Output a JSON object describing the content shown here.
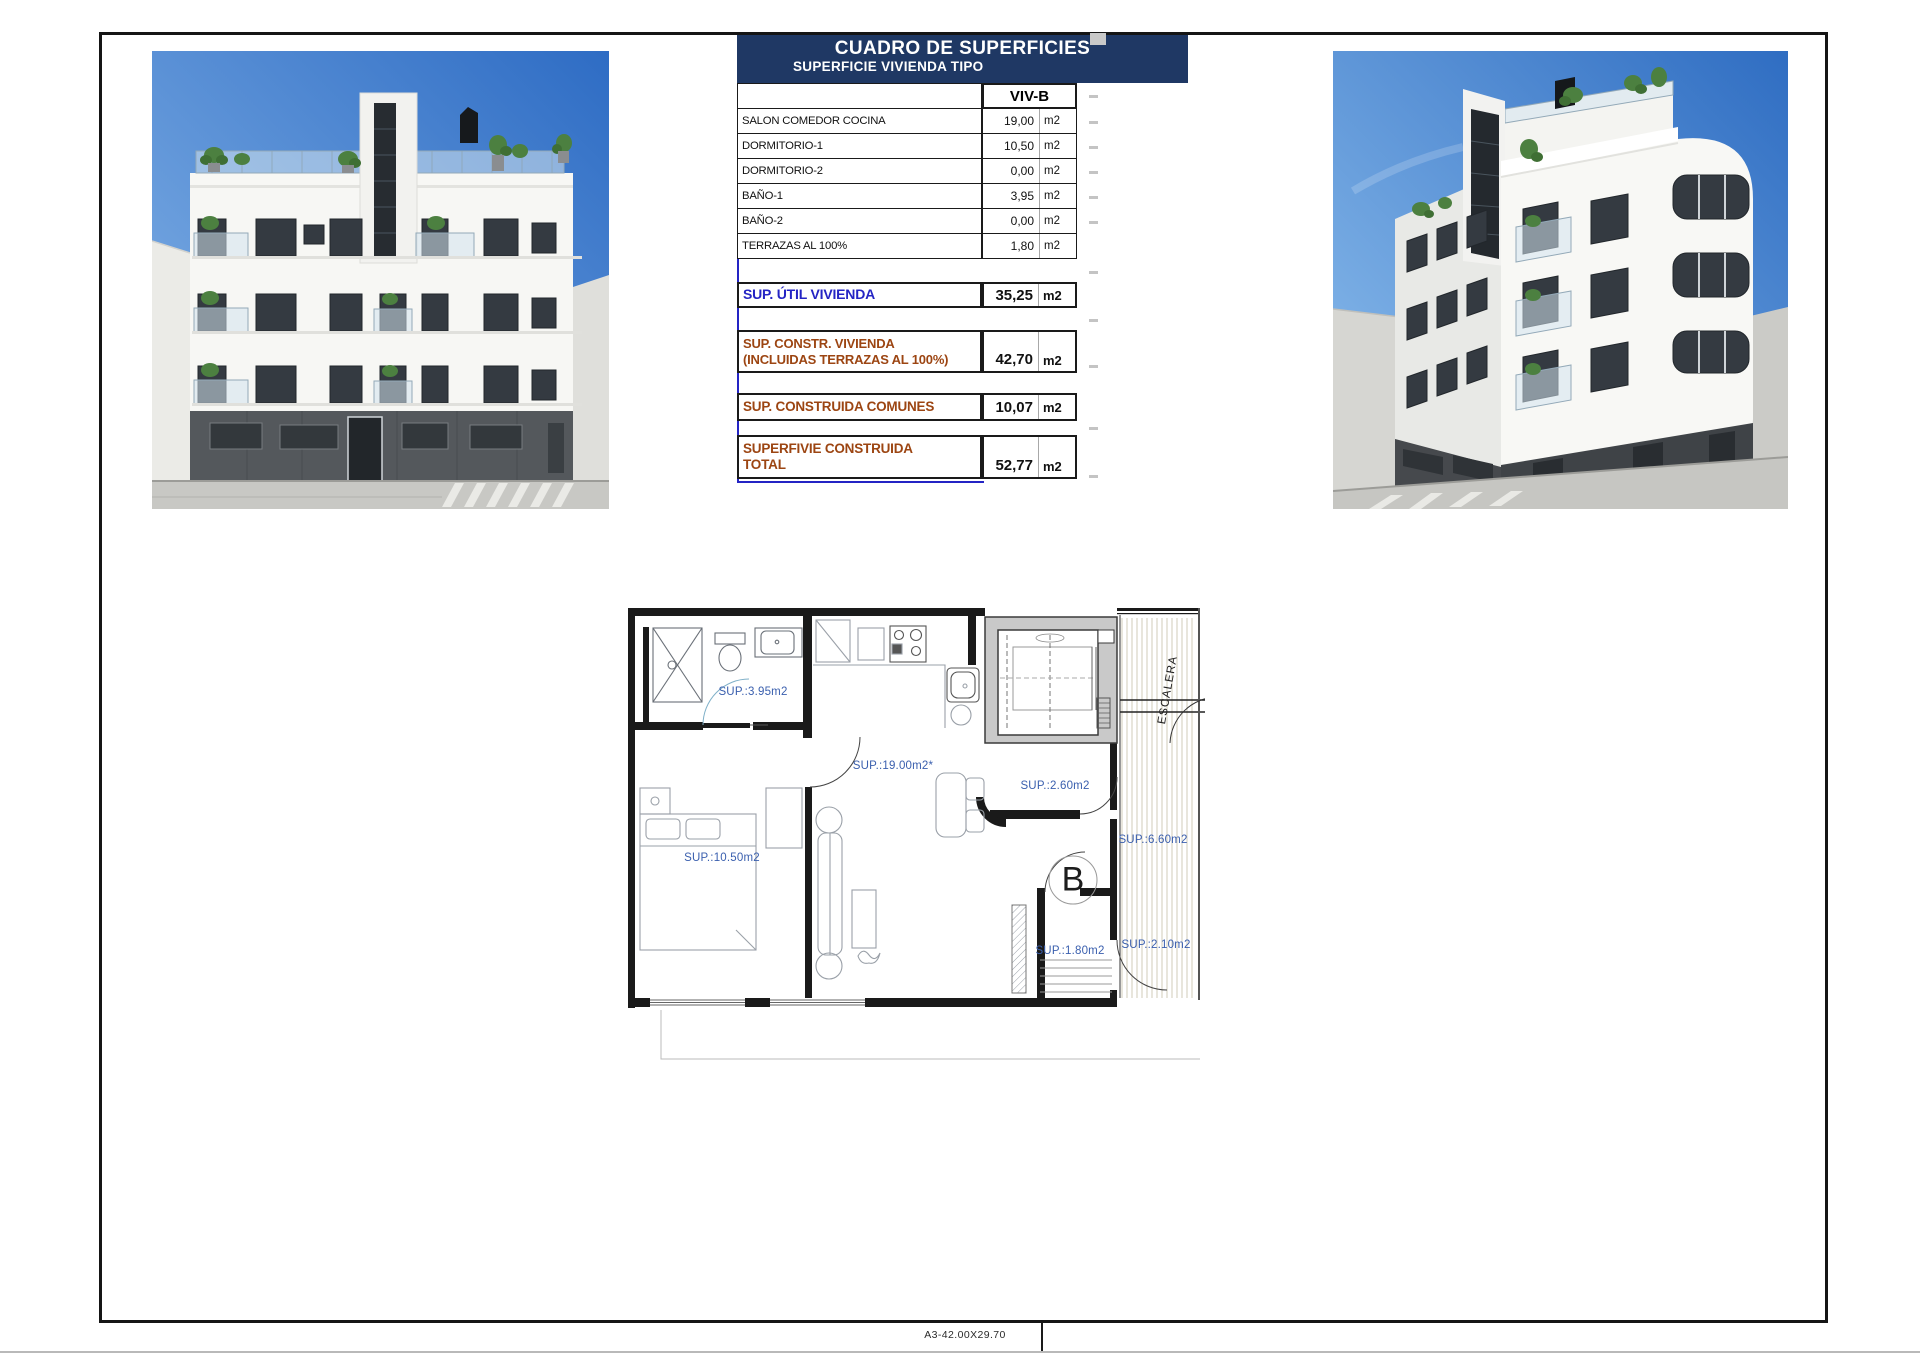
{
  "sheet": {
    "format_label": "A3-42.00X29.70"
  },
  "surface_table": {
    "title": "CUADRO DE SUPERFICIES",
    "subtitle": "SUPERFICIE VIVIENDA TIPO",
    "column_header": "VIV-B",
    "rows": [
      {
        "label": "SALON COMEDOR COCINA",
        "value": "19,00",
        "unit": "m2"
      },
      {
        "label": "DORMITORIO-1",
        "value": "10,50",
        "unit": "m2"
      },
      {
        "label": "DORMITORIO-2",
        "value": "0,00",
        "unit": "m2"
      },
      {
        "label": "BAÑO-1",
        "value": "3,95",
        "unit": "m2"
      },
      {
        "label": "BAÑO-2",
        "value": "0,00",
        "unit": "m2"
      },
      {
        "label": "TERRAZAS AL 100%",
        "value": "1,80",
        "unit": "m2"
      }
    ],
    "summary": [
      {
        "lines": [
          "SUP. ÚTIL VIVIENDA"
        ],
        "value": "35,25",
        "unit": "m2",
        "color": "blue"
      },
      {
        "lines": [
          "SUP. CONSTR. VIVIENDA",
          "(INCLUIDAS TERRAZAS AL 100%)"
        ],
        "value": "42,70",
        "unit": "m2",
        "color": "brown"
      },
      {
        "lines": [
          "SUP. CONSTRUIDA COMUNES"
        ],
        "value": "10,07",
        "unit": "m2",
        "color": "brown"
      },
      {
        "lines": [
          "SUPERFIVIE CONSTRUIDA",
          "TOTAL"
        ],
        "value": "52,77",
        "unit": "m2",
        "color": "brown"
      }
    ]
  },
  "floor_plan": {
    "unit_letter": "B",
    "stairs_label": "ESCALERA",
    "room_labels": [
      "SUP.:3.95m2",
      "SUP.:19.00m2*",
      "SUP.:10.50m2",
      "SUP.:2.60m2",
      "SUP.:6.60m2",
      "SUP.:1.80m2",
      "SUP.:2.10m2"
    ]
  },
  "colors": {
    "header_navy": "#1f3864",
    "total_blue": "#2424c4",
    "summary_brown": "#9c4512",
    "plan_label_blue": "#3a5fae",
    "sky_blue": "#2f6dc2"
  }
}
